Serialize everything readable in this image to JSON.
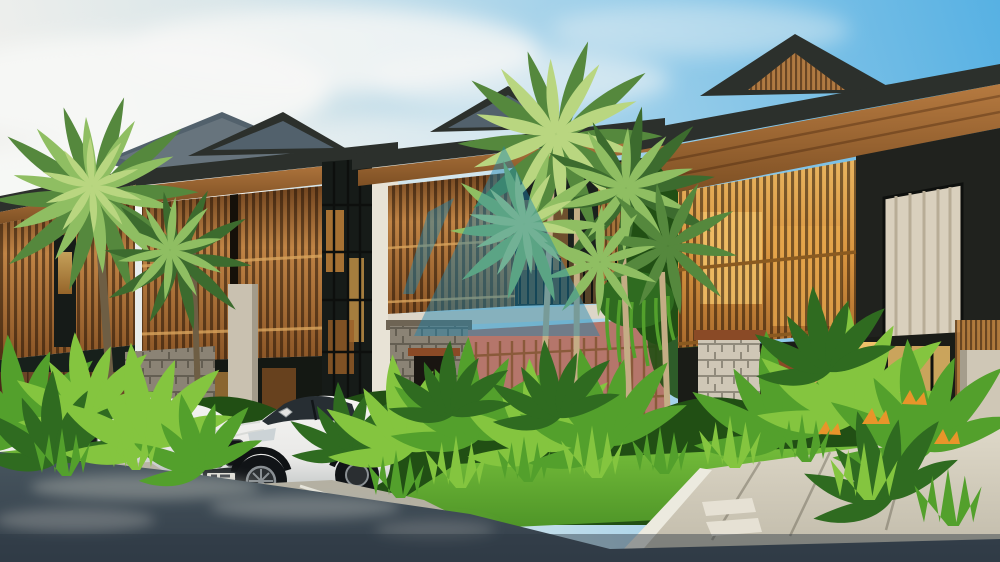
{
  "meta": {
    "kind": "architectural-3d-rendering",
    "subject": "Row of modern tropical two-storey townhouses with wooden slat facades, gabled dark roofs, palm trees, dense tropical landscaping, two white cars parked in front, asphalt road in foreground",
    "width": 1000,
    "height": 562
  },
  "scene": {
    "buildings": "four townhouse units receding to the left, golden timber slat screens, warm interior lighting, stone pillars, terracotta garden wall",
    "vehicles": [
      "white coupe with twin kidney grille",
      "white sedan partly hidden by foliage"
    ],
    "vegetation": "fan palms, banana-leaf shrubs, grass tufts, hanging vines, orange bird-of-paradise flowers",
    "watermark": "semi-transparent teal peak-shaped logo in upper centre"
  },
  "palette": {
    "sky_blue": "#57b1e3",
    "sky_mid": "#9fd0ea",
    "sky_pale": "#d9e6e9",
    "sky_white": "#efefec",
    "cloud": "#f7f8f6",
    "roof_dark": "#2c302c",
    "shingle": "#52616c",
    "shingle_hi": "#76838c",
    "soffit_hi": "#b67a40",
    "soffit_lo": "#7e5024",
    "gable_wood": "#b07a42",
    "slat_dark_top": "#70441f",
    "slat_gold": "#c08445",
    "slat_shadow": "#8a5526",
    "slat_bright_hi": "#e8b45f",
    "slat_bright_md": "#d9953f",
    "slat_bright_lo": "#a86a2d",
    "interior_glow_hi": "#f0c26a",
    "interior_glow_lo": "#b5772e",
    "glass_dark": "#161b18",
    "mullion": "#0e100e",
    "wall_white": "#e8e3d6",
    "wall_dark": "#20221e",
    "curtain": "#d9d0bd",
    "stone_gray": "#8b8375",
    "stone_light": "#cfc7b6",
    "pillar_light": "#c9c1b0",
    "terracotta": "#b5766b",
    "fence_wood": "#6b4326",
    "door_wood": "#8a4a26",
    "balcony_slab": "#ddd6c8",
    "palm_light": "#b9d680",
    "palm_green": "#8fbe62",
    "palm_dark": "#55883d",
    "palm_deep": "#3c6b2e",
    "trunk": "#c4ad85",
    "trunk_dark": "#6e5e44",
    "foliage_bright": "#84c53f",
    "foliage_mid": "#53a02c",
    "foliage_dark": "#2f6b20",
    "foliage_deep": "#214f14",
    "grass_hi": "#74bc3a",
    "grass_lo": "#4d9427",
    "flower_orange": "#e8952a",
    "road_hi": "#48565f",
    "road_lo": "#333e49",
    "road_patch": "#a9adaa",
    "pave_hi": "#ded8c8",
    "pave_lo": "#c2bcab",
    "curb": "#eceadf",
    "car_white": "#f5f4f2",
    "car_shade": "#c2c6c6",
    "car_glass": "#272e33",
    "tire": "#111417",
    "rim": "#8a9094",
    "headlight": "#ccd3d6",
    "plate": "#e9e7df",
    "watermark": "#1d85b0"
  }
}
